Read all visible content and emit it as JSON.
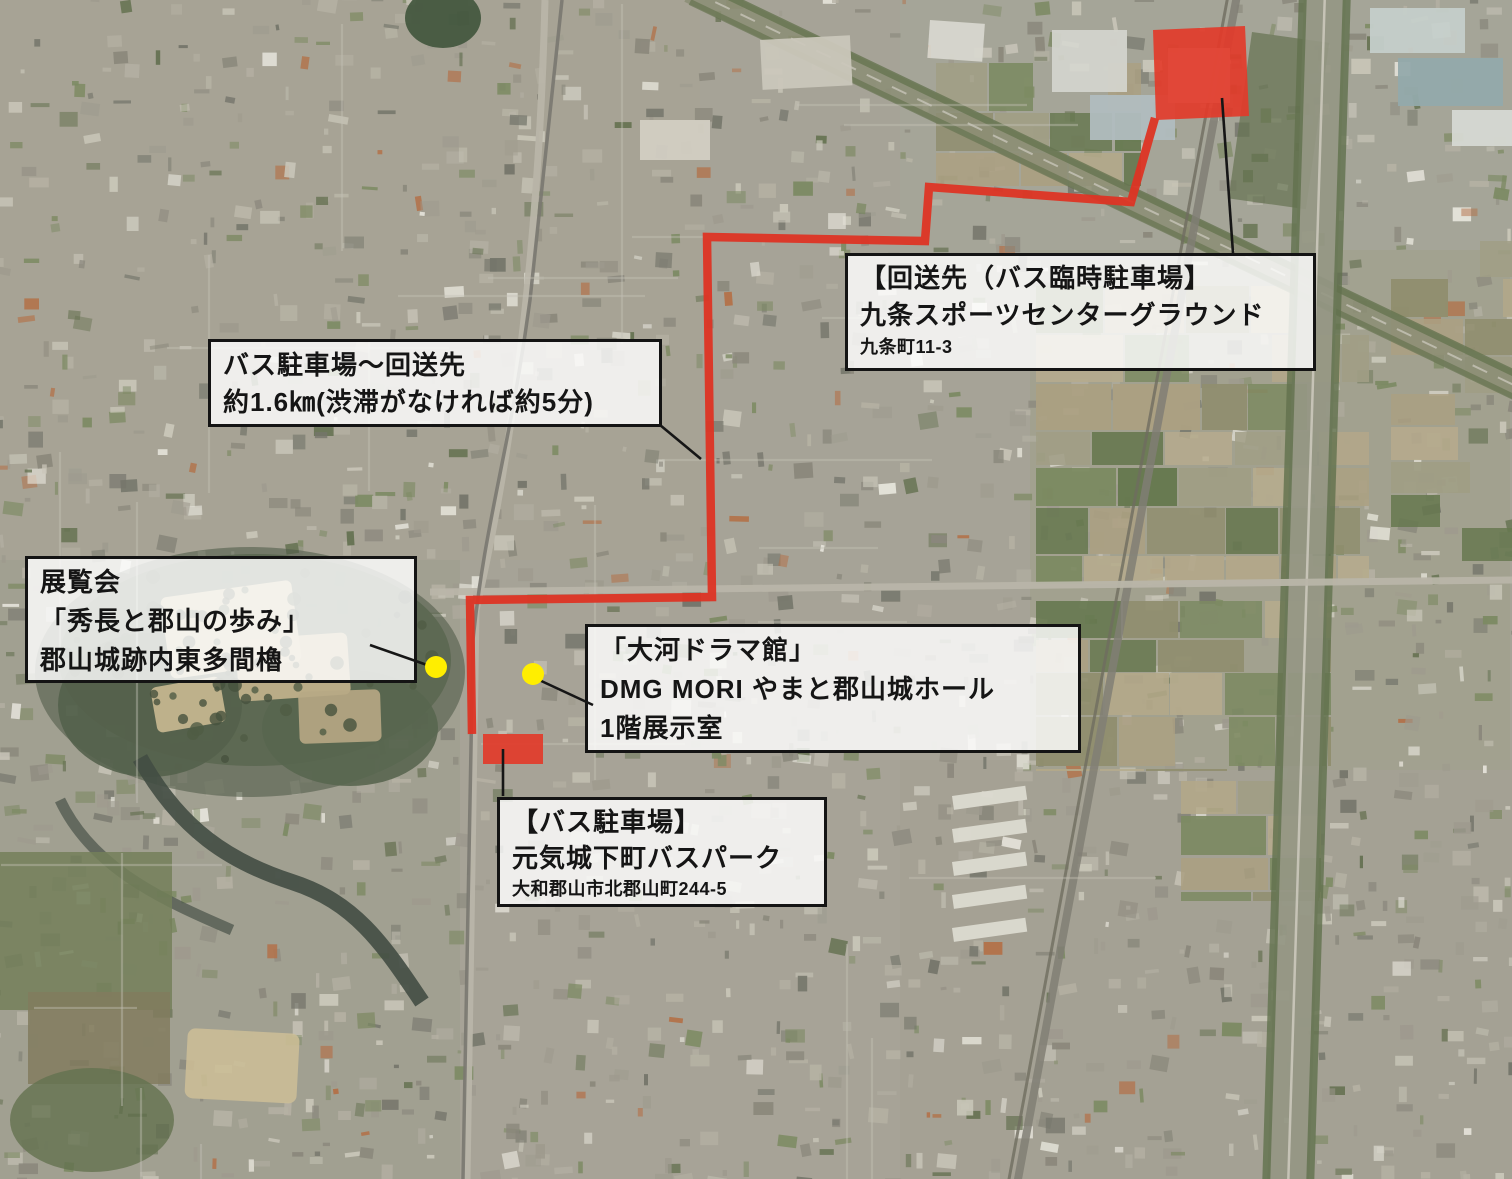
{
  "map": {
    "kind": "satellite-aerial-map",
    "colors": {
      "route": "#dd3424",
      "area_fill": "#e23b2a",
      "marker": "#ffee00",
      "leader": "#161616",
      "label_bg": "rgba(255,255,255,0.82)",
      "label_border": "#141414"
    }
  },
  "labels": {
    "destination": {
      "lines": [
        "【回送先（バス臨時駐車場】",
        "九条スポーツセンターグラウンド",
        "九条町11-3"
      ]
    },
    "route_info": {
      "lines": [
        "バス駐車場～回送先",
        "約1.6㎞(渋滞がなければ約5分)"
      ]
    },
    "exhibition": {
      "lines": [
        "展覧会",
        "「秀長と郡山の歩み」",
        "郡山城跡内東多間櫓"
      ]
    },
    "drama_hall": {
      "lines": [
        "「大河ドラマ館」",
        "DMG MORI やまと郡山城ホール",
        "1階展示室"
      ]
    },
    "bus_parking": {
      "lines": [
        "【バス駐車場】",
        "元気城下町バスパーク",
        "大和郡山市北郡山町244-5"
      ]
    }
  },
  "markers": {
    "destination_area": "red-filled-area",
    "bus_parking_area": "red-filled-rect",
    "exhibition_point": "yellow-dot",
    "drama_hall_point": "yellow-dot",
    "route_line": "red-route-line"
  }
}
